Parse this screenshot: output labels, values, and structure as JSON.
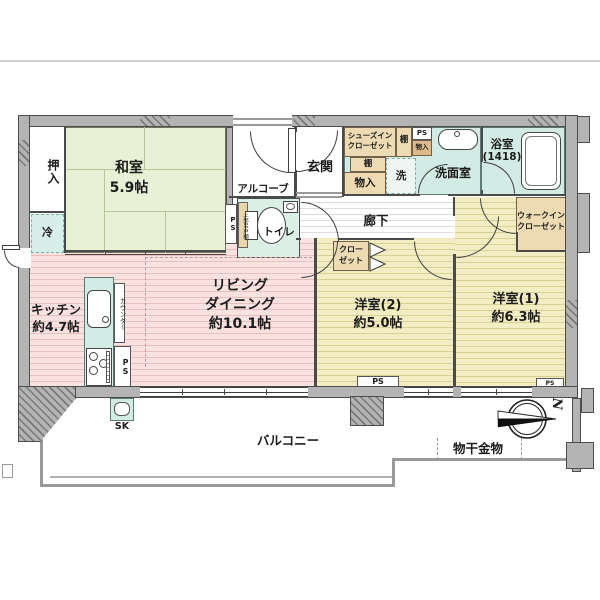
{
  "plan": {
    "rooms": {
      "washitsu": {
        "name": "和室",
        "size": "5.9帖"
      },
      "living_dining": {
        "name_line1": "リビング",
        "name_line2": "ダイニング",
        "size": "約10.1帖"
      },
      "kitchen": {
        "name": "キッチン",
        "size": "約4.7帖"
      },
      "youshitsu1": {
        "name": "洋室(1)",
        "size": "約6.3帖"
      },
      "youshitsu2": {
        "name": "洋室(2)",
        "size": "約5.0帖"
      },
      "bathroom": {
        "name": "浴室",
        "size": "(1418)"
      },
      "washroom": {
        "name": "洗面室"
      },
      "toilet": {
        "name": "トイレ",
        "shelf_note": "上部吊戸棚"
      },
      "genkan": {
        "name": "玄関"
      },
      "alcove": {
        "name": "アルコーブ"
      },
      "hallway": {
        "name": "廊下"
      },
      "walk_in_closet": {
        "name_line1": "ウォークイン",
        "name_line2": "クローゼット"
      },
      "shoes_in_closet": {
        "name_line1": "シューズイン",
        "name_line2": "クローゼット"
      },
      "closet": {
        "name_line1": "クロー",
        "name_line2": "ゼット"
      },
      "oshiire": {
        "name": "押入"
      },
      "balcony": {
        "name": "バルコニー"
      }
    },
    "fixtures": {
      "refrigerator": "冷",
      "washer": "洗",
      "counter": "カウンター",
      "shelf": "棚",
      "storage": "物入",
      "pipe_space": "PS",
      "slop_sink": "SK",
      "laundry_hardware": "物干金物",
      "north": "N"
    },
    "colors": {
      "tatami": "#e8f0d6",
      "flooring_ld": "#f9e2e0",
      "flooring_bedroom": "#f2edc2",
      "wet_area": "#d3ebe5",
      "storage_beige": "#eedbb4",
      "outer_wall": "#b4b4b4"
    }
  }
}
